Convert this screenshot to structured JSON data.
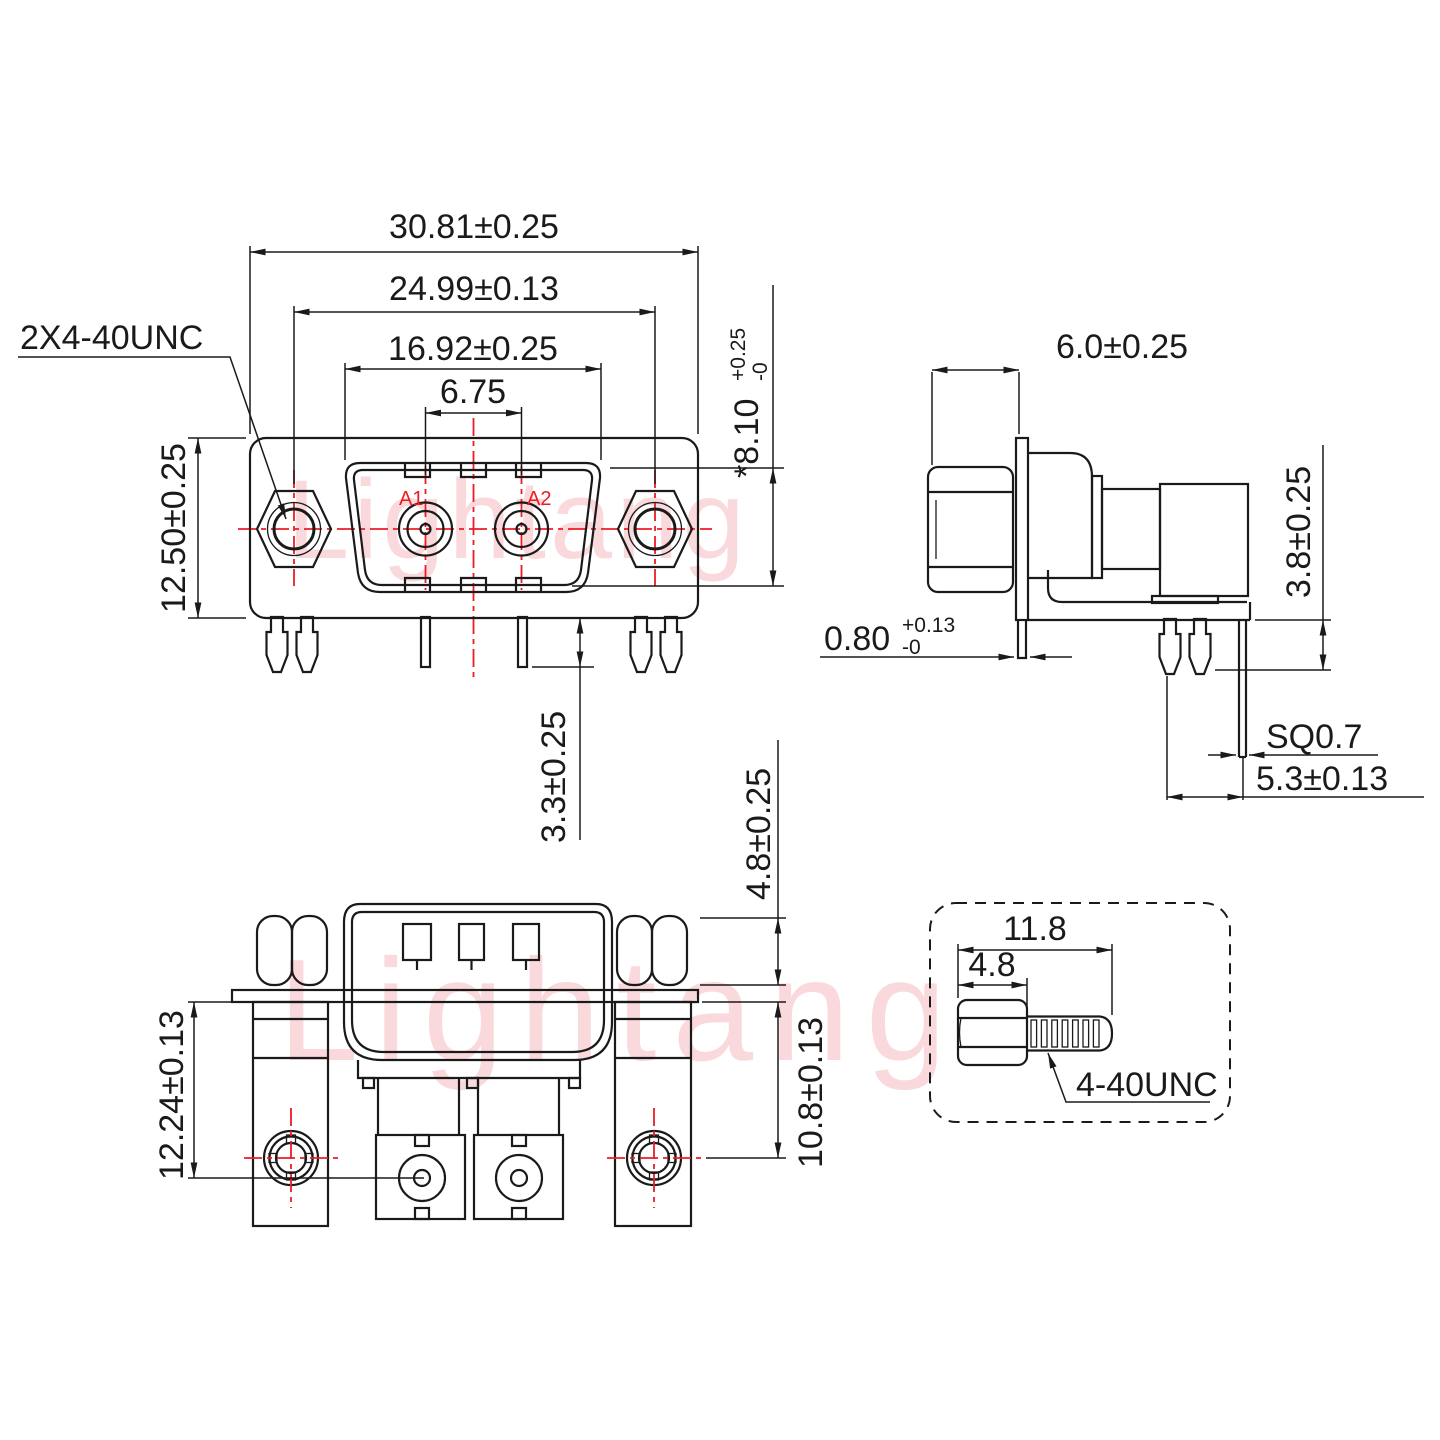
{
  "watermark": {
    "text": "Lightang"
  },
  "colors": {
    "line": "#1a1a1a",
    "centerline": "#ed1c24",
    "watermark": "#f8c0c6",
    "background": "#ffffff"
  },
  "front_view": {
    "thread_note": "2X4-40UNC",
    "dim_overall_width": "30.81±0.25",
    "dim_mount_pitch": "24.99±0.13",
    "dim_shell_width": "16.92±0.25",
    "dim_contact_pitch": "6.75",
    "dim_height": "12.50±0.25",
    "dim_shell_height_main": "*8.10",
    "dim_shell_height_tol_plus": "+0.25",
    "dim_shell_height_tol_minus": "-0",
    "dim_pin_length": "3.3±0.25",
    "contact_a1": "A1",
    "contact_a2": "A2"
  },
  "side_view": {
    "dim_head_depth": "6.0±0.25",
    "dim_pin_height": "3.8±0.25",
    "dim_flange_main": "0.80",
    "dim_flange_tol_plus": "+0.13",
    "dim_flange_tol_minus": "-0",
    "dim_pin_square": "SQ0.7",
    "dim_pin_offset": "5.3±0.13"
  },
  "bottom_view": {
    "dim_lock_height": "12.24±0.13",
    "dim_contact_height": "10.8±0.13",
    "dim_standoff_height": "4.8±0.25"
  },
  "screw_detail": {
    "dim_total_length": "11.8",
    "dim_head_length": "4.8",
    "thread_label": "4-40UNC"
  }
}
